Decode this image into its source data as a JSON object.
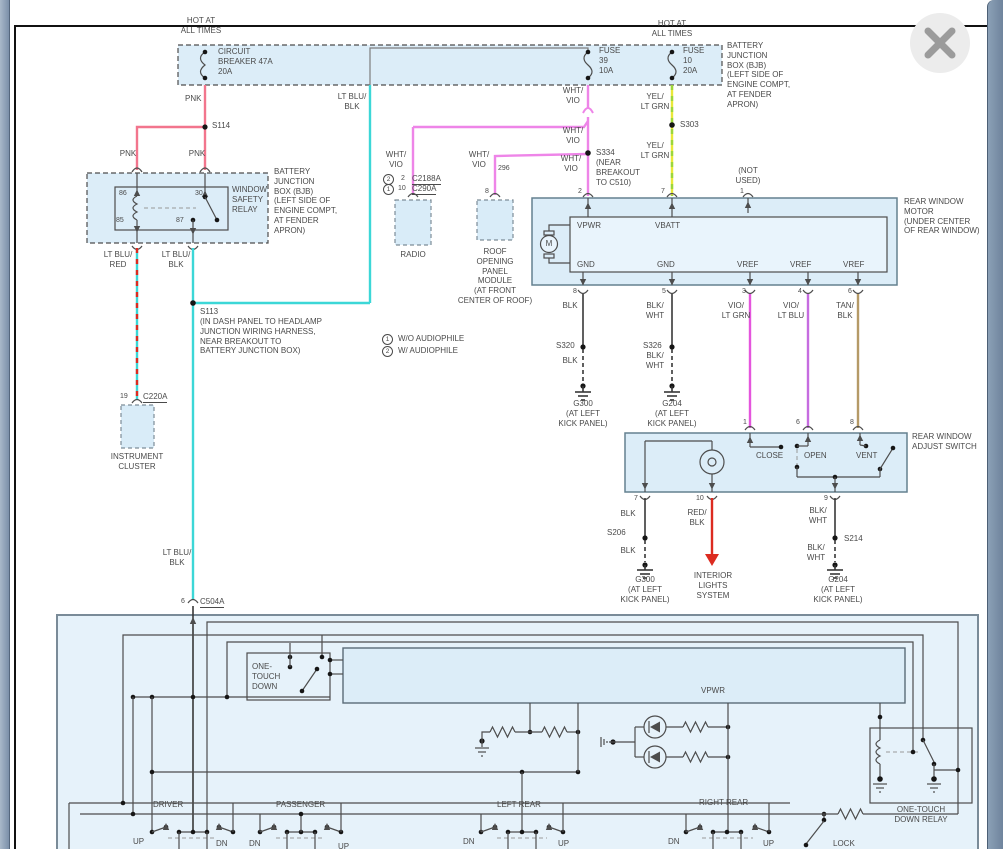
{
  "window": {
    "close_icon": "✕"
  },
  "colors": {
    "pink": "#F2758D",
    "cyan": "#3CD7D7",
    "violet": "#EE85E8",
    "yellow": "#E8E838",
    "lt_green": "#9BD63A",
    "magenta": "#E455DD",
    "purple": "#C66CE0",
    "tan": "#B59A67",
    "red": "#DC2B20",
    "box_fill": "#DCEDF8",
    "frame_blue": "#7B90A9"
  },
  "labels": {
    "hot1": "HOT AT\nALL TIMES",
    "cb": "CIRCUIT\nBREAKER 47A\n20A",
    "fuse39": "FUSE\n39\n10A",
    "fuse10": "FUSE\n10\n20A",
    "hot2": "HOT AT\nALL TIMES",
    "bjb_top": "BATTERY\nJUNCTION\nBOX (BJB)\n(LEFT SIDE OF\nENGINE COMPT,\nAT FENDER\nAPRON)",
    "pnk_a": "PNK",
    "pnk_b": "PNK",
    "pnk_c": "PNK",
    "s114": "S114",
    "r86": "86",
    "r30": "30",
    "r85": "85",
    "r87": "87",
    "wsr": "WINDOW\nSAFETY\nRELAY",
    "bjb_relay": "BATTERY\nJUNCTION\nBOX (BJB)\n(LEFT SIDE OF\nENGINE COMPT,\nAT FENDER\nAPRON)",
    "ltblu_red": "LT BLU/\nRED",
    "ltblu_blk1": "LT BLU/\nBLK",
    "ltblu_blk2": "LT BLU/\nBLK",
    "ltblu_blk3": "LT BLU/\nBLK",
    "s113": "S113",
    "s113_desc": "(IN DASH PANEL TO HEADLAMP\nJUNCTION WIRING HARNESS,\nNEAR BREAKOUT TO\nBATTERY JUNCTION BOX)",
    "pin19": "19",
    "c220a": "C220A",
    "instcluster": "INSTRUMENT\nCLUSTER",
    "pin6": "6",
    "c504a": "C504A",
    "whtvio1": "WHT/\nVIO",
    "whtvio2": "WHT/\nVIO",
    "whtvio3": "WHT/\nVIO",
    "whtvio4": "WHT/\nVIO",
    "whtvio5": "WHT/\nVIO",
    "s334": "S334",
    "s334_desc": "(NEAR\nBREAKOUT\nTO C510)",
    "radio_c2": "2",
    "radio_p2": "2",
    "radio_c2188a": "C2188A",
    "radio_c1": "1",
    "radio_p10": "10",
    "radio_c290a": "C290A",
    "radio": "RADIO",
    "w296": "296",
    "roof_pin8": "8",
    "roof": "ROOF\nOPENING\nPANEL\nMODULE\n(AT FRONT\nCENTER OF ROOF)",
    "yelgrn1": "YEL/\nLT GRN",
    "yelgrn2": "YEL/\nLT GRN",
    "s303": "S303",
    "notused": "(NOT\nUSED)",
    "mpin2": "2",
    "mpin7": "7",
    "mpin1": "1",
    "vpwr": "VPWR",
    "vbatt": "VBATT",
    "gnd1": "GND",
    "gnd2": "GND",
    "vref1": "VREF",
    "vref2": "VREF",
    "vref3": "VREF",
    "motor_m": "M",
    "rwm": "REAR WINDOW\nMOTOR\n(UNDER CENTER\nOF REAR WINDOW)",
    "bpin8": "8",
    "bpin5": "5",
    "bpin3": "3",
    "bpin4": "4",
    "bpin6": "6",
    "blk1": "BLK",
    "s320": "S320",
    "blk2": "BLK",
    "g300a": "G300\n(AT LEFT\nKICK PANEL)",
    "blkwht1": "BLK/\nWHT",
    "s326": "S326",
    "blkwht2": "BLK/\nWHT",
    "g204a": "G204\n(AT LEFT\nKICK PANEL)",
    "violtgrn": "VIO/\nLT GRN",
    "violtblu": "VIO/\nLT BLU",
    "tanblk": "TAN/\nBLK",
    "spin1": "1",
    "spin6": "6",
    "spin8": "8",
    "close_sw": "CLOSE",
    "open_sw": "OPEN",
    "vent_sw": "VENT",
    "rwas": "REAR WINDOW\nADJUST SWITCH",
    "spin7": "7",
    "spin10": "10",
    "spin9": "9",
    "blk3": "BLK",
    "s206": "S206",
    "blk4": "BLK",
    "g300b": "G300\n(AT LEFT\nKICK PANEL)",
    "redblk": "RED/\nBLK",
    "ils": "INTERIOR\nLIGHTS\nSYSTEM",
    "blkwht3": "BLK/\nWHT",
    "s214": "S214",
    "blkwht4": "BLK/\nWHT",
    "g204b": "G204\n(AT LEFT\nKICK PANEL)",
    "audc1": "1",
    "aud1": "W/O AUDIOPHILE",
    "audc2": "2",
    "aud2": "W/ AUDIOPHILE",
    "otd": "ONE-\nTOUCH\nDOWN",
    "vpwr2": "VPWR",
    "otdr": "ONE-TOUCH\nDOWN RELAY",
    "driver": "DRIVER",
    "passenger": "PASSENGER",
    "leftrear": "LEFT REAR",
    "rightrear": "RIGHT REAR",
    "up1": "UP",
    "dn1": "DN",
    "dn2": "DN",
    "up2": "UP",
    "dn3": "DN",
    "up3": "UP",
    "dn4": "DN",
    "up4": "UP",
    "lock": "LOCK"
  }
}
